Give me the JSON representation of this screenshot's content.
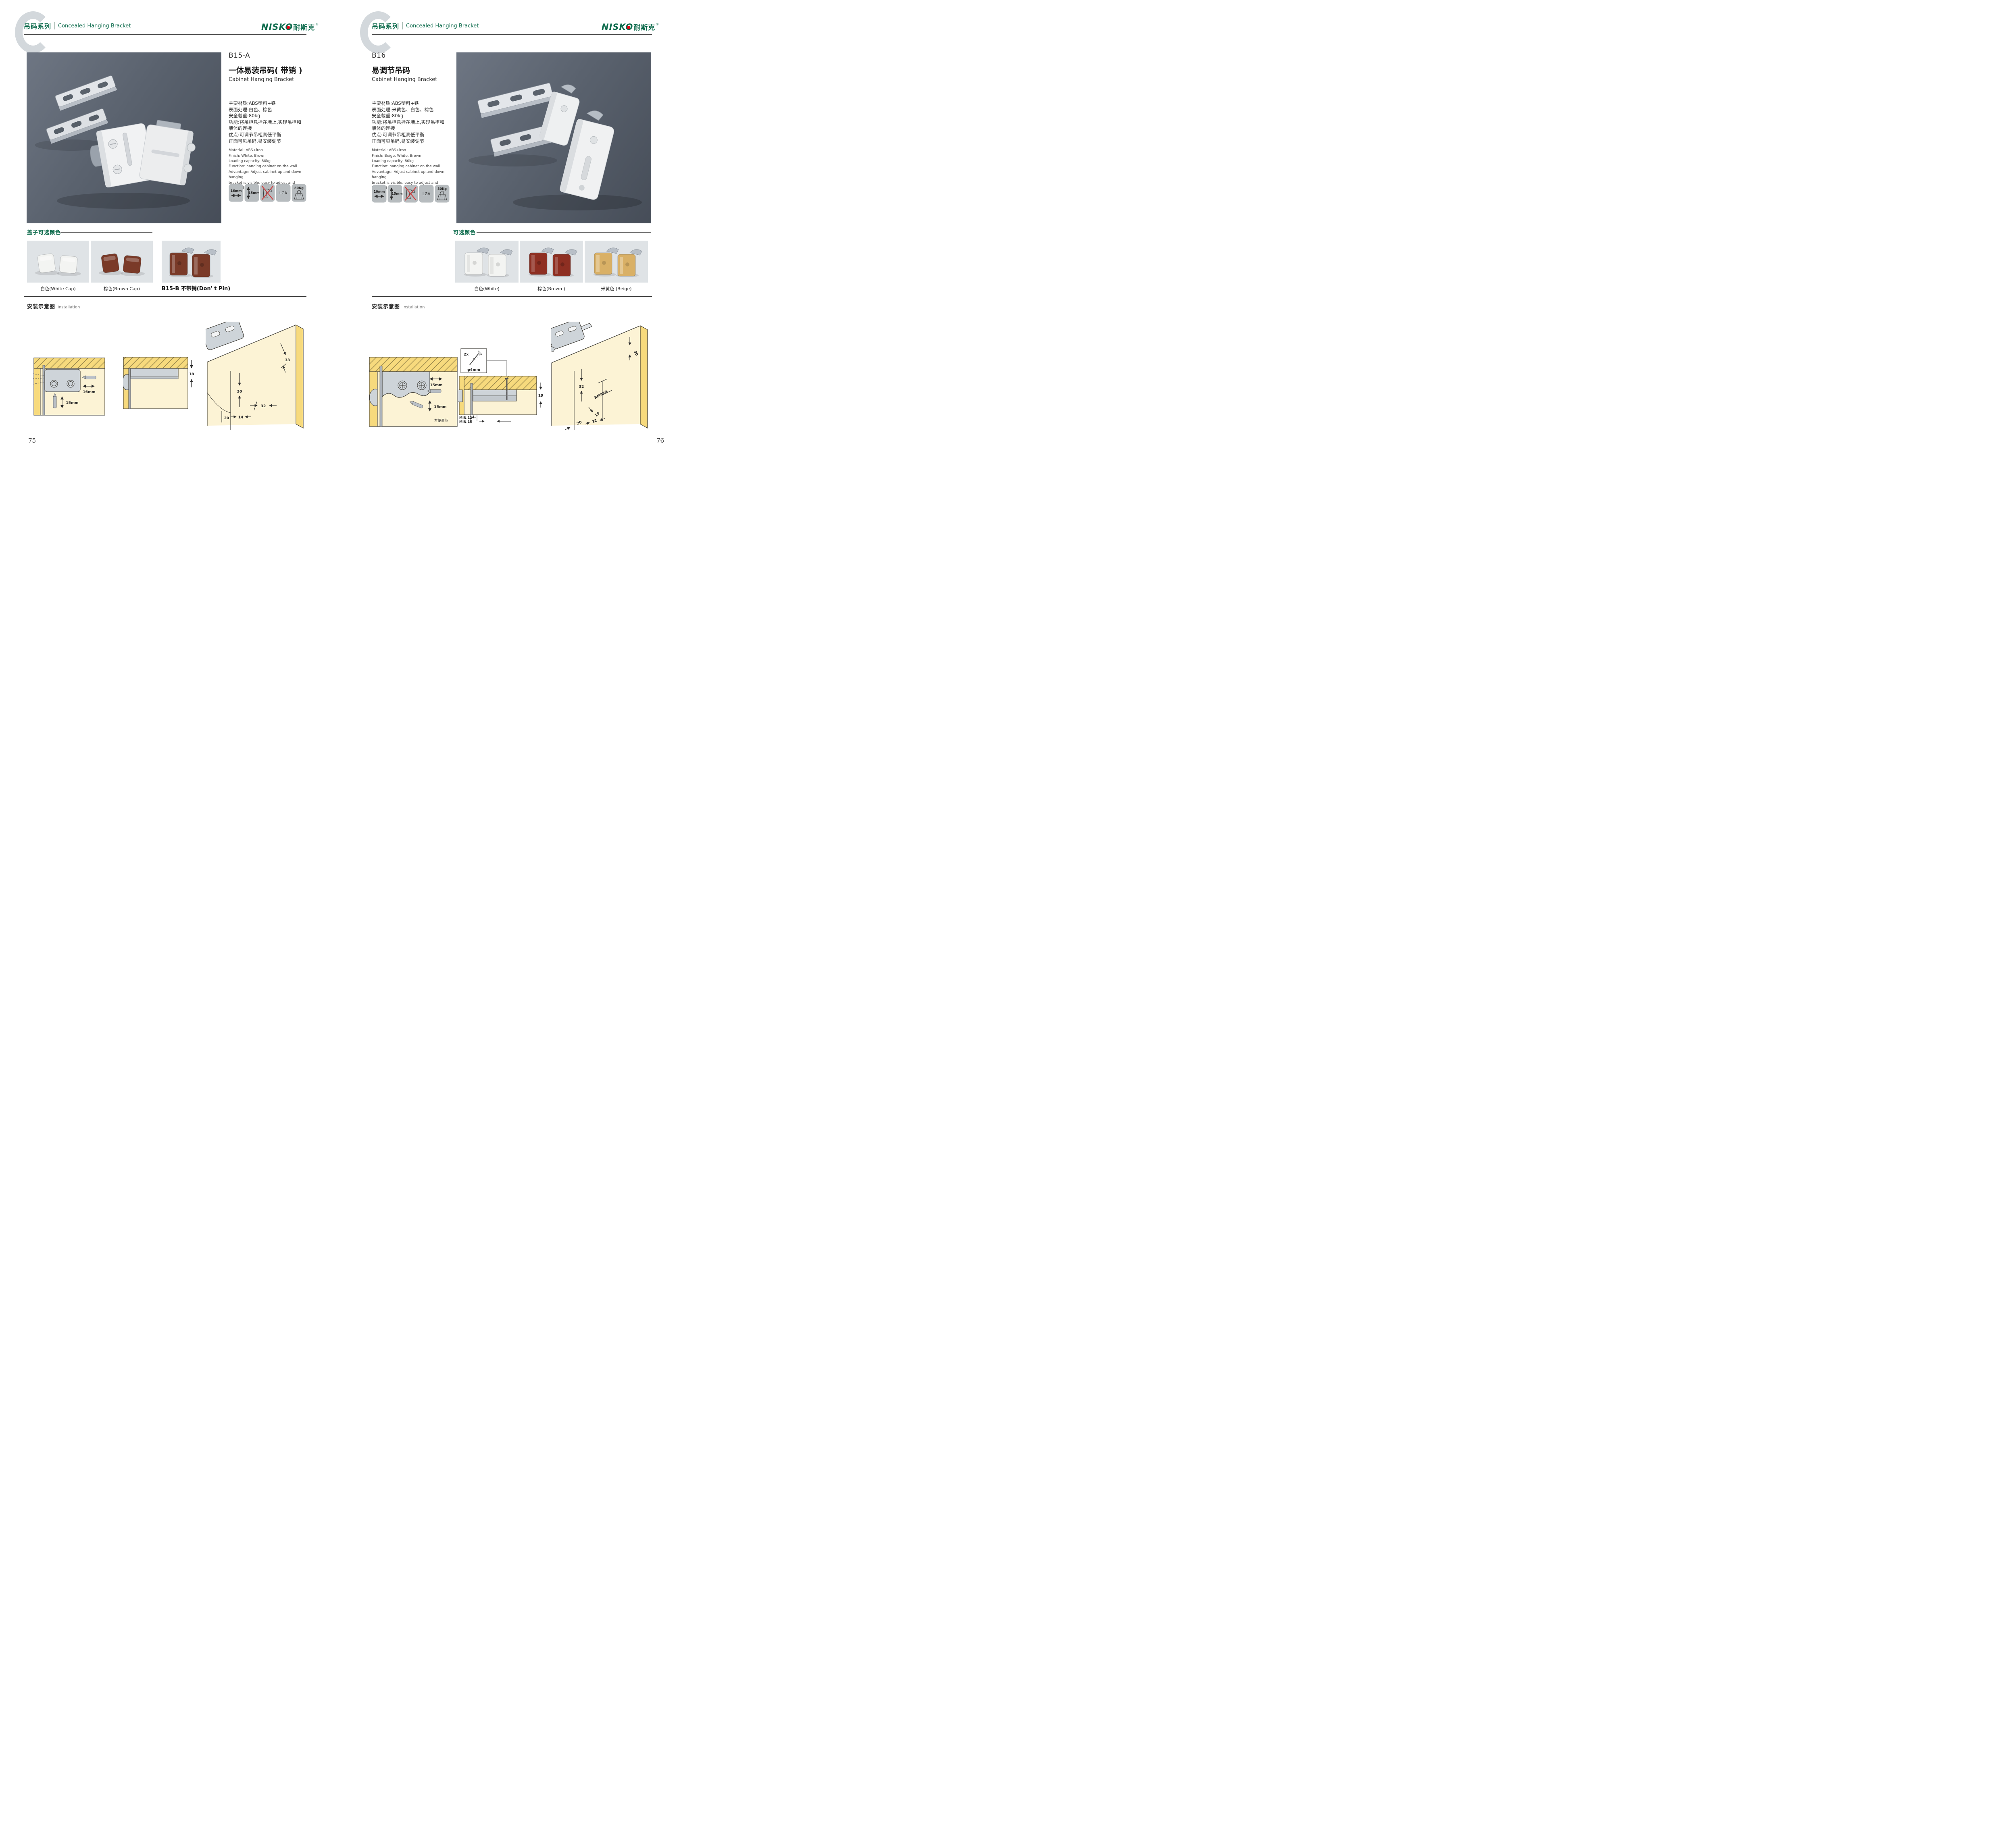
{
  "brand": {
    "latin": "NISKO",
    "cn": "耐斯克",
    "reg": "®",
    "green": "#0d6b4c",
    "red": "#e60012"
  },
  "header": {
    "series_cn": "吊码系列",
    "series_en": "Concealed Hanging Bracket"
  },
  "installation": {
    "cn": "安装示意图",
    "en": "Installation"
  },
  "pages": [
    {
      "page_number": "75",
      "product": {
        "code": "B15-A",
        "name_cn": "一体易装吊码( 带销 )",
        "name_en": "Cabinet Hanging Bracket",
        "specs_cn": [
          "主要材质:ABS塑料+铁",
          "表面处理:白色、棕色",
          "安全载重:80kg",
          "功能:将吊柜悬挂在墙上,实现吊柜和",
          "墙体的连接",
          "优点:可调节吊柜高低平衡",
          "正面可见吊码,易安装调节"
        ],
        "specs_en": [
          "Material: ABS+iron",
          "Finish: White, Brown",
          "Loading capacity: 80kg",
          "Function: hanging cabinet on the wall",
          "Advantage: Adjust cabinet up and down hanging",
          "bracket is visible, easy to adjust and installed"
        ]
      },
      "icons": [
        {
          "type": "width",
          "label": "16mm"
        },
        {
          "type": "height",
          "label": "15mm"
        },
        {
          "type": "no-drill",
          "label": ""
        },
        {
          "type": "cert",
          "label": "LGA"
        },
        {
          "type": "load",
          "label": "80Kg"
        }
      ],
      "colors": {
        "heading": "盖子可选颜色",
        "items": [
          {
            "label": "白色(White Cap)",
            "hex": "#f3f4f2"
          },
          {
            "label": "棕色(Brown Cap)",
            "hex": "#7a3a28"
          },
          {
            "label": "B15-B 不带销(Don' t Pin)",
            "hex": "#7a3a28"
          }
        ]
      },
      "diagrams": [
        {
          "dims": [
            "16mm",
            "15mm"
          ]
        },
        {
          "dims": [
            "18"
          ]
        },
        {
          "dims": [
            "33",
            "30",
            "32",
            "20",
            "14"
          ]
        }
      ]
    },
    {
      "page_number": "76",
      "product": {
        "code": "B16",
        "name_cn": "易调节吊码",
        "name_en": "Cabinet Hanging Bracket",
        "specs_cn": [
          "主要材质:ABS塑料+铁",
          "表面处理:米黄色、白色、棕色",
          "安全载重:80kg",
          "功能:将吊柜悬挂在墙上,实现吊柜和",
          "墙体的连接",
          "优点:可调节吊柜高低平衡",
          "正面可见吊码,易安装调节"
        ],
        "specs_en": [
          "Material: ABS+iron",
          "Finish: Beige, White, Brown",
          "Loading capacity: 80kg",
          "Function: hanging cabinet on the wall",
          "Advantage: Adjust cabinet up and down hanging",
          "bracket is visible, easy to adjust and installed"
        ]
      },
      "icons": [
        {
          "type": "width",
          "label": "10mm"
        },
        {
          "type": "height",
          "label": "15mm"
        },
        {
          "type": "no-drill",
          "label": ""
        },
        {
          "type": "cert",
          "label": "LGA"
        },
        {
          "type": "load",
          "label": "80Kg"
        }
      ],
      "colors": {
        "heading": "可选颜色",
        "items": [
          {
            "label": "白色(White)",
            "hex": "#f3f4f2"
          },
          {
            "label": "棕色(Brown )",
            "hex": "#8e2f22"
          },
          {
            "label": "米黄色 (Beige)",
            "hex": "#d9b066"
          }
        ]
      },
      "diagrams": [
        {
          "dims": [
            "15mm",
            "15mm"
          ],
          "note": "方便调节"
        },
        {
          "dims": [
            "19",
            "MIN.12",
            "MIN.15"
          ],
          "screw_qty": "2x",
          "screw_dia": "φ4mm"
        },
        {
          "dims": [
            "30",
            "32",
            "19",
            "20",
            "32"
          ],
          "note": "RMAX4"
        }
      ]
    }
  ]
}
